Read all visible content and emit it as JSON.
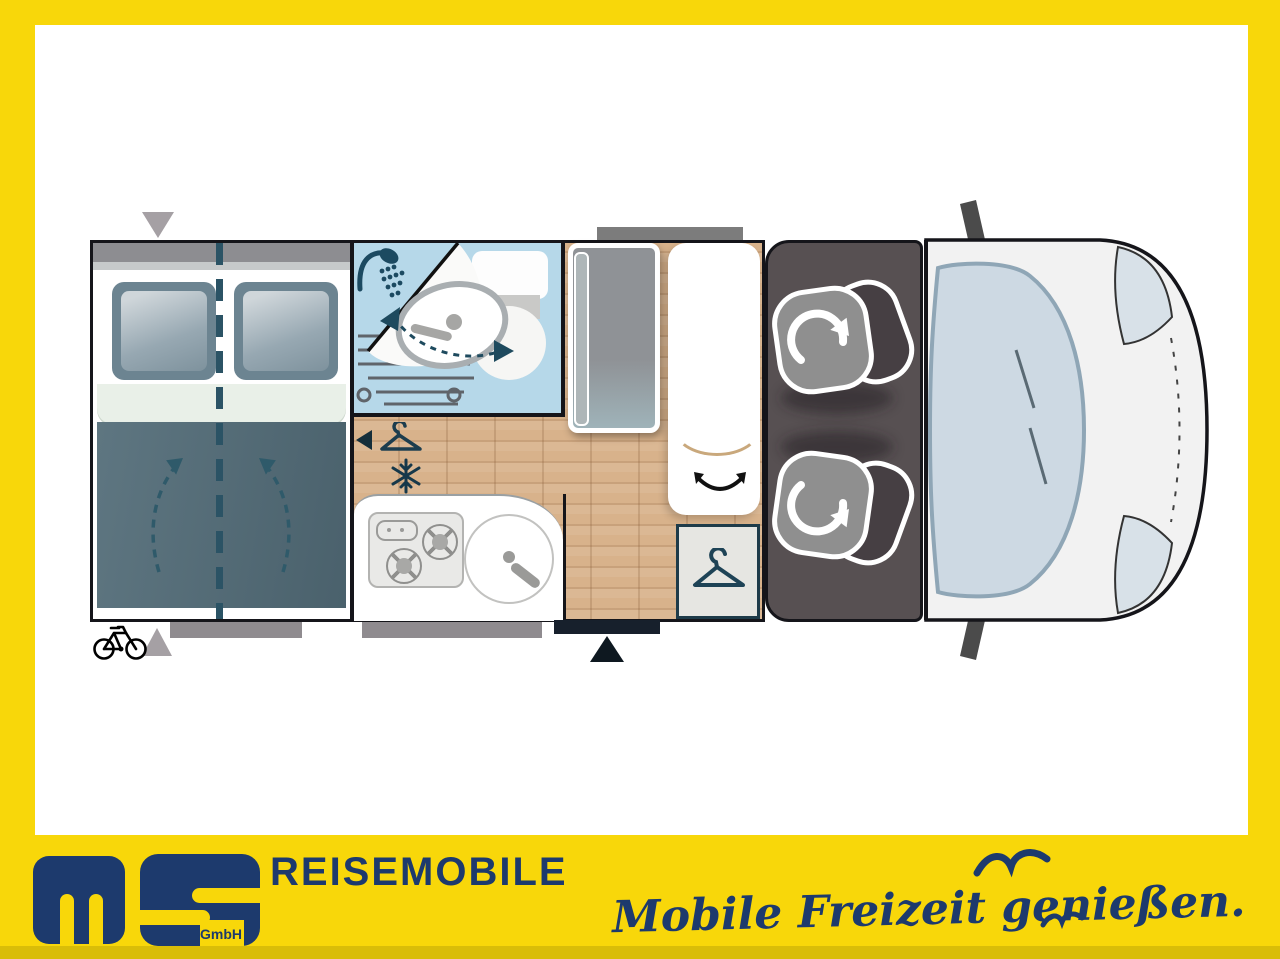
{
  "brand": {
    "logo_sub": "GmbH",
    "company": "REISEMOBILE",
    "tagline": "Mobile Freizeit genießen."
  },
  "colors": {
    "frame_yellow": "#F8D70A",
    "frame_yellow_dark": "#D9BD08",
    "brand_navy": "#1D3A6D",
    "wall": "#15151A",
    "bath_blue": "#B6D8E9",
    "wood": "#D8B28B",
    "cab_panel": "#575052",
    "duvet": "#566F7B",
    "accent_teal": "#2B5365",
    "marker_gray": "#A5A0A4",
    "strip_gray": "#8F8B8F"
  },
  "floorplan": {
    "zones": [
      "rear-double-bed",
      "bathroom",
      "kitchen",
      "dinette-table",
      "bench-seat",
      "wardrobe",
      "swivel-cab-seats",
      "driver-cab"
    ],
    "icons": [
      "shower-icon",
      "washbasin",
      "toilet",
      "hanger-icon",
      "snowflake-icon",
      "hob-burners",
      "round-sink",
      "swivel-arrow-icon",
      "rotation-arrow-icon",
      "entry-door-triangle",
      "bed-access-triangle",
      "bike-rack-icon",
      "seagull-icon"
    ]
  }
}
